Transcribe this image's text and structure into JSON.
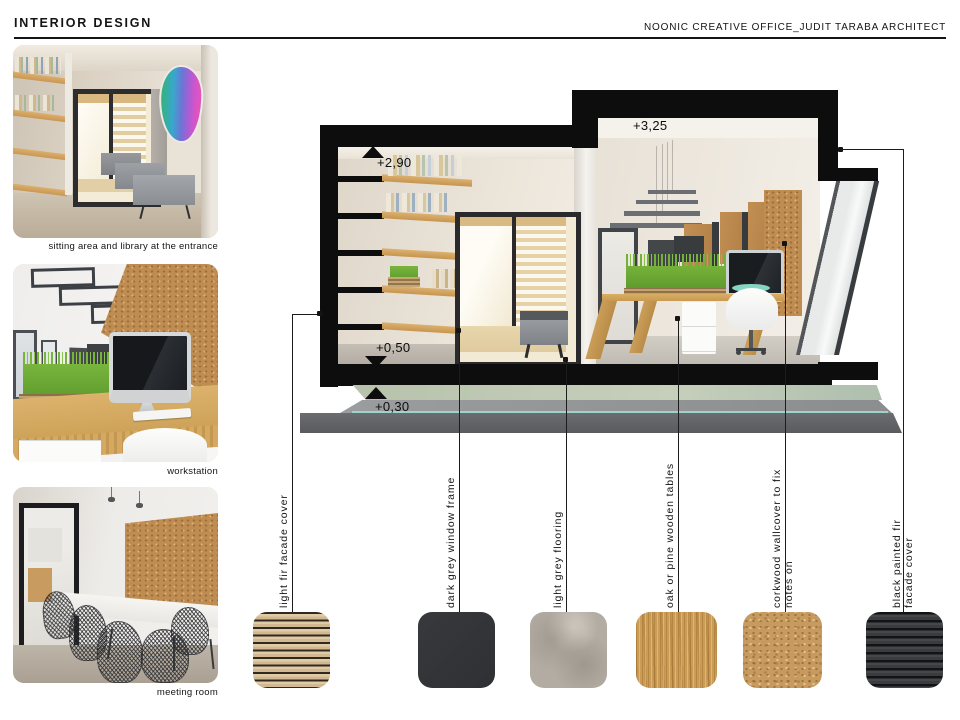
{
  "header": {
    "title": "INTERIOR DESIGN",
    "project": "NOONIC CREATIVE OFFICE_JUDIT TARABA ARCHITECT"
  },
  "gallery": {
    "items": [
      {
        "caption": "sitting area and library at the entrance"
      },
      {
        "caption": "workstation"
      },
      {
        "caption": "meeting room"
      }
    ]
  },
  "section_drawing": {
    "description": "cutaway cross-section of the office interior",
    "markers": [
      {
        "label": "+2,90",
        "direction": "up"
      },
      {
        "label": "+3,25",
        "direction": "up"
      },
      {
        "label": "+0,50",
        "direction": "down"
      },
      {
        "label": "+0,30",
        "direction": "up"
      }
    ]
  },
  "materials": {
    "items": [
      {
        "label_lines": [
          "light fir facade cover"
        ],
        "swatch": "light-fir",
        "color": "#d9c3a0"
      },
      {
        "label_lines": [
          "dark grey window frame"
        ],
        "swatch": "dark-grey",
        "color": "#323438"
      },
      {
        "label_lines": [
          "light grey flooring"
        ],
        "swatch": "light-grey",
        "color": "#b3aca3"
      },
      {
        "label_lines": [
          "oak or pine wooden tables"
        ],
        "swatch": "oak",
        "color": "#cb9c55"
      },
      {
        "label_lines": [
          "corkwood wallcover to fix",
          "notes on"
        ],
        "swatch": "cork",
        "color": "#c79a5f"
      },
      {
        "label_lines": [
          "black painted fir",
          "facade cover"
        ],
        "swatch": "black-fir",
        "color": "#3e4043"
      }
    ]
  }
}
